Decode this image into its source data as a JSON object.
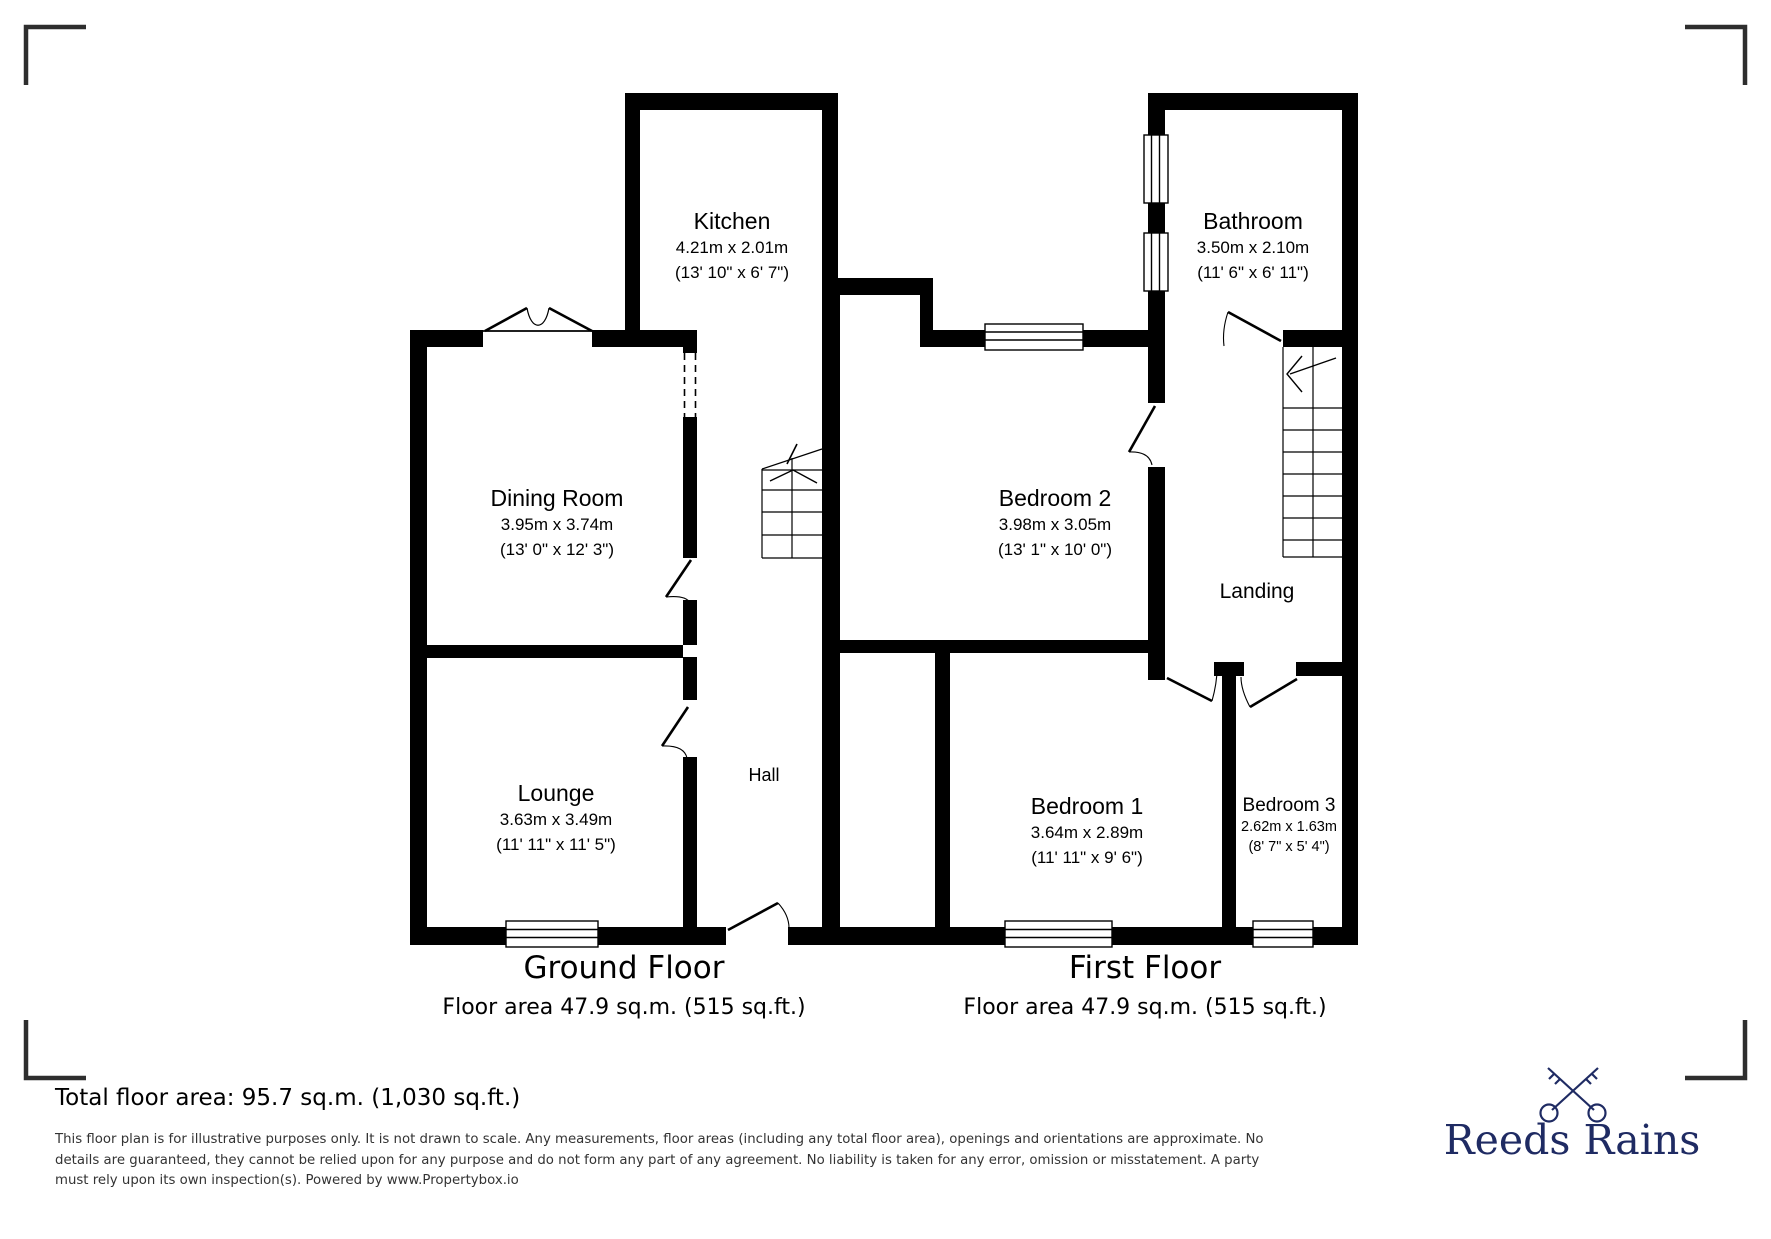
{
  "ground_floor": {
    "title": "Ground Floor",
    "area": "Floor area 47.9 sq.m. (515 sq.ft.)",
    "rooms": {
      "kitchen": {
        "name": "Kitchen",
        "metric": "4.21m x 2.01m",
        "imperial": "(13' 10\" x 6' 7\")"
      },
      "dining": {
        "name": "Dining Room",
        "metric": "3.95m x 3.74m",
        "imperial": "(13' 0\" x 12' 3\")"
      },
      "lounge": {
        "name": "Lounge",
        "metric": "3.63m x 3.49m",
        "imperial": "(11' 11\" x 11' 5\")"
      },
      "hall": {
        "name": "Hall"
      }
    }
  },
  "first_floor": {
    "title": "First Floor",
    "area": "Floor area 47.9 sq.m. (515 sq.ft.)",
    "rooms": {
      "bathroom": {
        "name": "Bathroom",
        "metric": "3.50m x 2.10m",
        "imperial": "(11' 6\" x 6' 11\")"
      },
      "bedroom2": {
        "name": "Bedroom 2",
        "metric": "3.98m x 3.05m",
        "imperial": "(13' 1\" x 10' 0\")"
      },
      "bedroom1": {
        "name": "Bedroom 1",
        "metric": "3.64m x 2.89m",
        "imperial": "(11' 11\" x 9' 6\")"
      },
      "bedroom3": {
        "name": "Bedroom 3",
        "metric": "2.62m x 1.63m",
        "imperial": "(8' 7\" x 5' 4\")"
      },
      "landing": {
        "name": "Landing"
      }
    }
  },
  "footer": {
    "total": "Total floor area: 95.7 sq.m. (1,030 sq.ft.)",
    "disclaimer": [
      "This floor plan is for illustrative purposes only. It is not drawn to scale. Any measurements, floor areas (including any total floor area), openings and orientations are approximate. No",
      "details are guaranteed, they cannot be relied upon for any purpose and do not form any part of any agreement. No liability is taken for any error, omission or misstatement. A party",
      "must rely upon its own inspection(s). Powered by www.Propertybox.io"
    ],
    "brand": "Reeds Rains"
  },
  "colors": {
    "wall": "#000000",
    "brand": "#1f2b63"
  }
}
